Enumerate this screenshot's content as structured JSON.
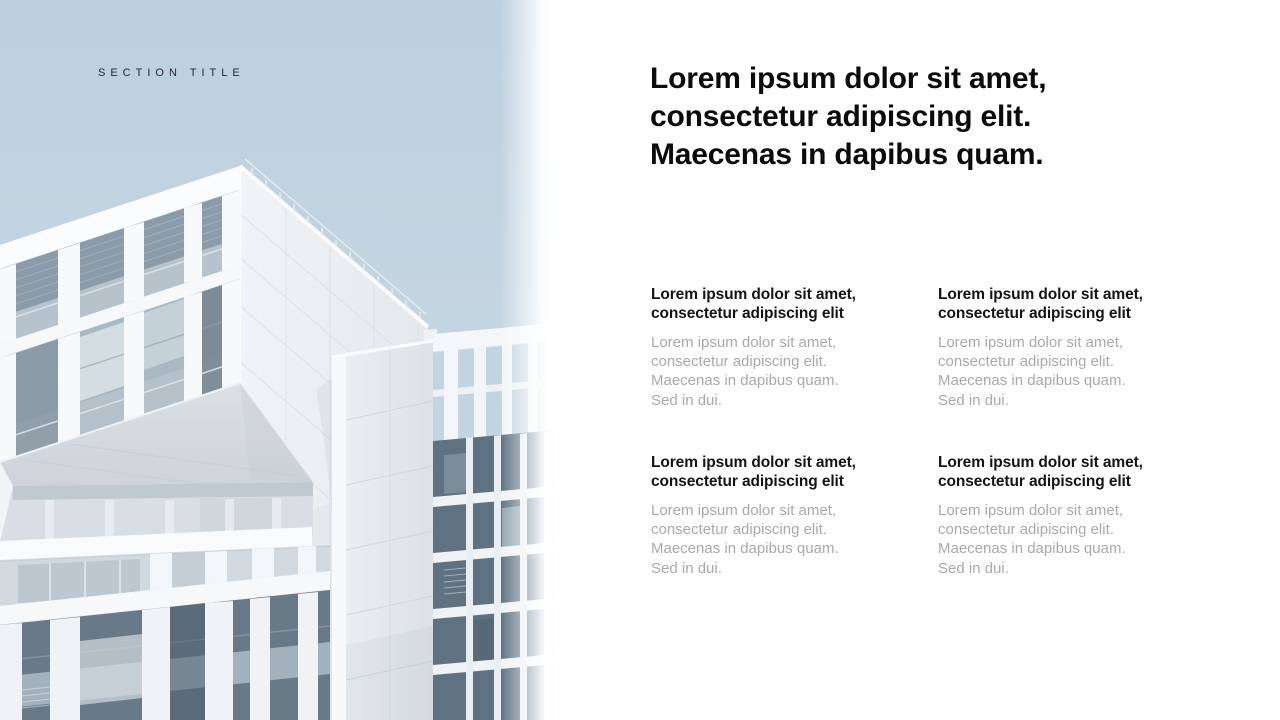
{
  "slide": {
    "section_label": "SECTION TITLE",
    "title_lines": [
      "Lorem ipsum dolor sit amet,",
      "consectetur adipiscing elit.",
      "Maecenas in dapibus quam."
    ],
    "image_alt": "modern white building against pale blue sky"
  },
  "blocks": [
    {
      "heading_lines": [
        "Lorem ipsum dolor sit amet,",
        "consectetur adipiscing elit"
      ],
      "body_lines": [
        "Lorem ipsum dolor sit amet,",
        "consectetur adipiscing elit.",
        "Maecenas in dapibus quam.",
        "Sed in dui."
      ]
    },
    {
      "heading_lines": [
        "Lorem ipsum dolor sit amet,",
        "consectetur adipiscing elit"
      ],
      "body_lines": [
        "Lorem ipsum dolor sit amet,",
        "consectetur adipiscing elit.",
        "Maecenas in dapibus quam.",
        "Sed in dui."
      ]
    },
    {
      "heading_lines": [
        "Lorem ipsum dolor sit amet,",
        "consectetur adipiscing elit"
      ],
      "body_lines": [
        "Lorem ipsum dolor sit amet,",
        "consectetur adipiscing elit.",
        "Maecenas in dapibus quam.",
        "Sed in dui."
      ]
    },
    {
      "heading_lines": [
        "Lorem ipsum dolor sit amet,",
        "consectetur adipiscing elit"
      ],
      "body_lines": [
        "Lorem ipsum dolor sit amet,",
        "consectetur adipiscing elit.",
        "Maecenas in dapibus quam.",
        "Sed in dui."
      ]
    }
  ],
  "colors": {
    "background": "#ffffff",
    "sky": "#c4d5e2",
    "title_text": "#0b0b0b",
    "heading_text": "#141414",
    "body_text": "#a9a9a9",
    "section_label_text": "#23292e",
    "building_white": "#f5f7f9",
    "building_shadow": "#e3e8ec",
    "glass": "#8fa1ae"
  }
}
